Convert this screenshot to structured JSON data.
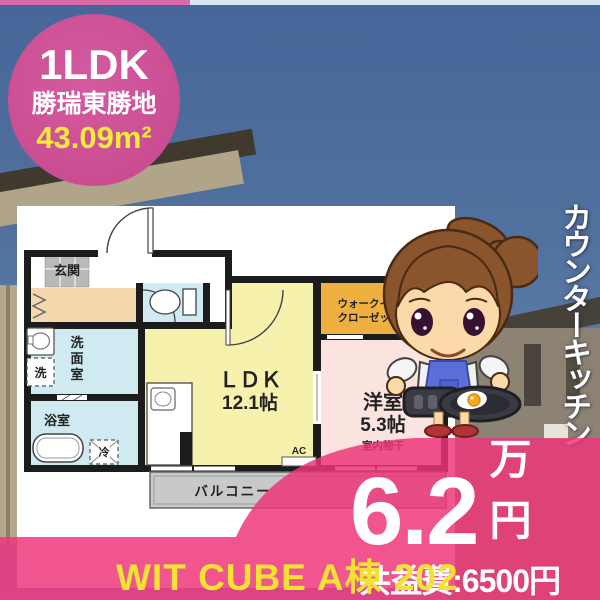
{
  "badge": {
    "layout": "1LDK",
    "location": "勝瑞東勝地",
    "area_value": "43.09",
    "area_unit": "m²"
  },
  "side_label": "カウンターキッチン",
  "price": {
    "rent_value": "6.2",
    "rent_unit": "万円",
    "common_fee": "共益費:6500円"
  },
  "footer": {
    "property_name": "WIT CUBE A棟 202"
  },
  "floorplan": {
    "genkan": "玄関",
    "washroom_chars": [
      "洗",
      "面",
      "室"
    ],
    "washer": "洗",
    "bath": "浴室",
    "fridge": "冷",
    "ldk_title": "ＬＤＫ",
    "ldk_size": "12.1帖",
    "closet_line1": "ウォークイン",
    "closet_line2": "クローゼット",
    "bedroom": "洋室",
    "bedroom_size": "5.3帖",
    "drying": "室内物干",
    "balcony": "バルコニー",
    "ac": "AC"
  },
  "colors": {
    "accent_pink": "#ee347a",
    "badge_pink": "#ca4d91",
    "highlight_yellow": "#f6ea3a",
    "ldk_yellow": "#f6f1ad",
    "bedroom_pink": "#fbe4e0",
    "closet_orange": "#edb041",
    "wet_area_cyan": "#cfeaf0",
    "hall_tan": "#f3d8ae"
  }
}
